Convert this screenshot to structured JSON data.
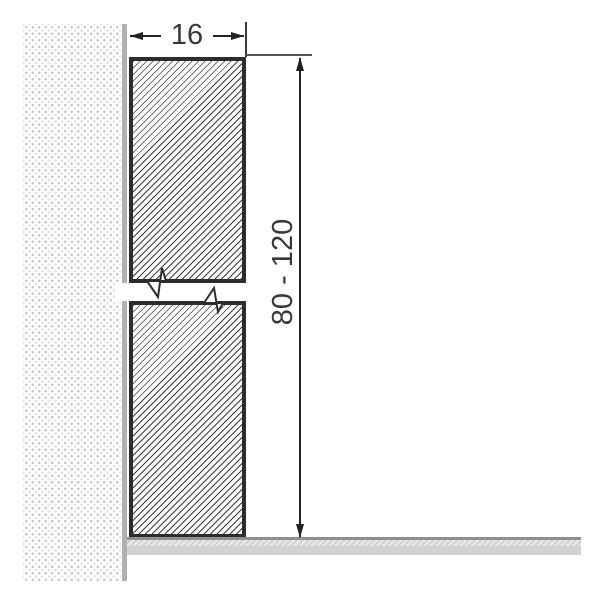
{
  "drawing": {
    "width_dimension": {
      "label": "16"
    },
    "height_dimension": {
      "label": "80 - 120"
    }
  },
  "icons": {
    "arrow_left_icon": "solid triangle pointing left (dimension arrow)",
    "arrow_right_icon": "solid triangle pointing right (dimension arrow)",
    "arrow_up_icon": "solid triangle pointing up (dimension arrow)",
    "arrow_down_icon": "solid triangle pointing down (dimension arrow)",
    "break_mark_upper": "zigzag section-break mark on upper profile segment",
    "break_mark_lower": "zigzag section-break mark on lower profile segment"
  },
  "colors": {
    "outline": "#2d2d2d",
    "dimension": "#222222",
    "hatch_line": "#3c3c3c",
    "wall_dot": "#c6c6c6",
    "wall_dot_light": "#e0e0e0",
    "wall_face": "#b0b0b0",
    "floor_band": "#d2d2d2",
    "floor_band_hatched": "#e6e6e6",
    "floor_hatch": "#c6c6c6",
    "floor_line": "#a8a8a8",
    "floor_edge": "#8f8f8f"
  }
}
